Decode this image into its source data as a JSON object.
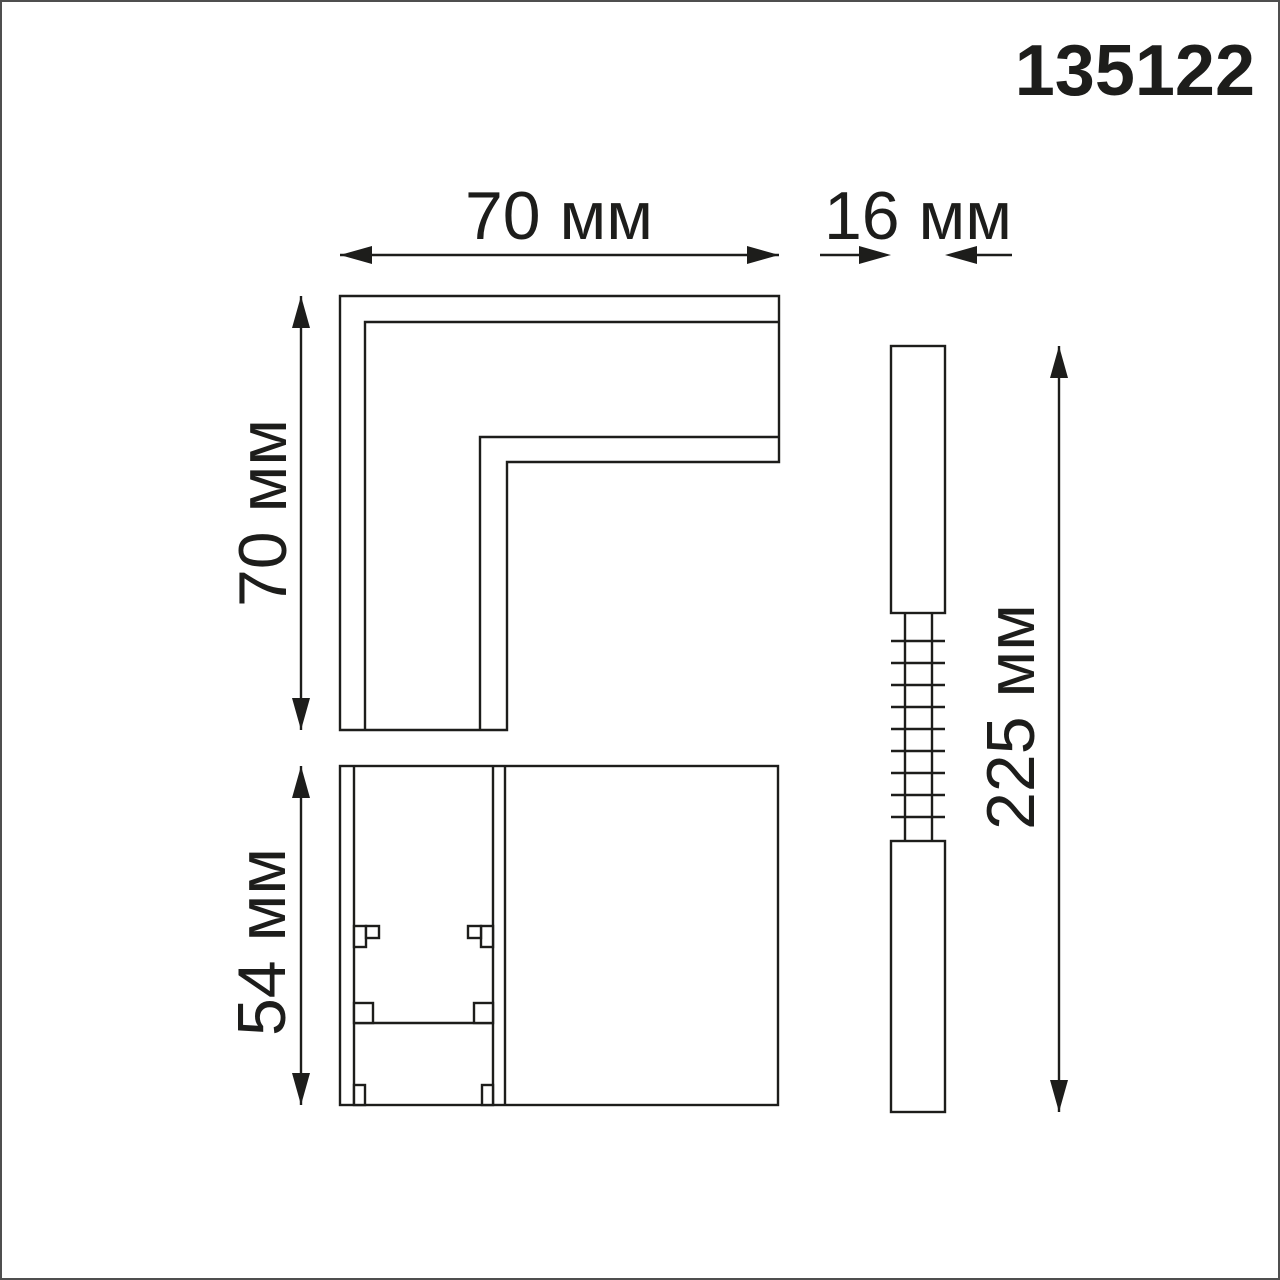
{
  "product_code": "135122",
  "colors": {
    "line": "#1d1d1b",
    "background": "#ffffff",
    "frame": "#4f4f4f"
  },
  "dimensions": {
    "top_width": {
      "value": 70,
      "unit": "мм",
      "label": "70 мм"
    },
    "side_width": {
      "value": 16,
      "unit": "мм",
      "label": "16 мм"
    },
    "left_height": {
      "value": 70,
      "unit": "мм",
      "label": "70 мм"
    },
    "front_height": {
      "value": 54,
      "unit": "мм",
      "label": "54 мм"
    },
    "side_height": {
      "value": 225,
      "unit": "мм",
      "label": "225 мм"
    }
  }
}
